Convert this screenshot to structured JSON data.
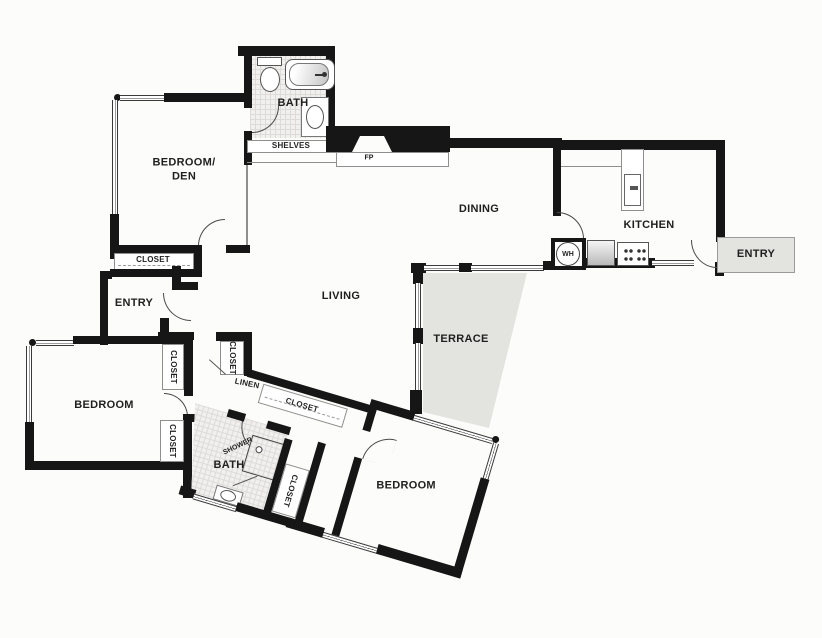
{
  "plan": {
    "labels": {
      "bath_top": "BATH",
      "shelves": "SHELVES",
      "fireplace": "FP",
      "bedroom_den_1": "BEDROOM/",
      "bedroom_den_2": "DEN",
      "closet": "CLOSET",
      "dining": "DINING",
      "kitchen": "KITCHEN",
      "water_heater": "WH",
      "entry_outer": "ENTRY",
      "entry_inner": "ENTRY",
      "living": "LIVING",
      "terrace": "TERRACE",
      "bedroom_left": "BEDROOM",
      "bedroom_right": "BEDROOM",
      "linen": "LINEN",
      "bath_lower": "BATH",
      "shower": "SHOWER"
    },
    "colors": {
      "wall": "#161616",
      "shaded_area": "#e3e3e0",
      "tile": "#f1f0ee",
      "tile_grid": "#dcdbd8",
      "fixture_stroke": "#555555",
      "label_text": "#1f1f1f",
      "background": "#fcfcfa"
    }
  }
}
